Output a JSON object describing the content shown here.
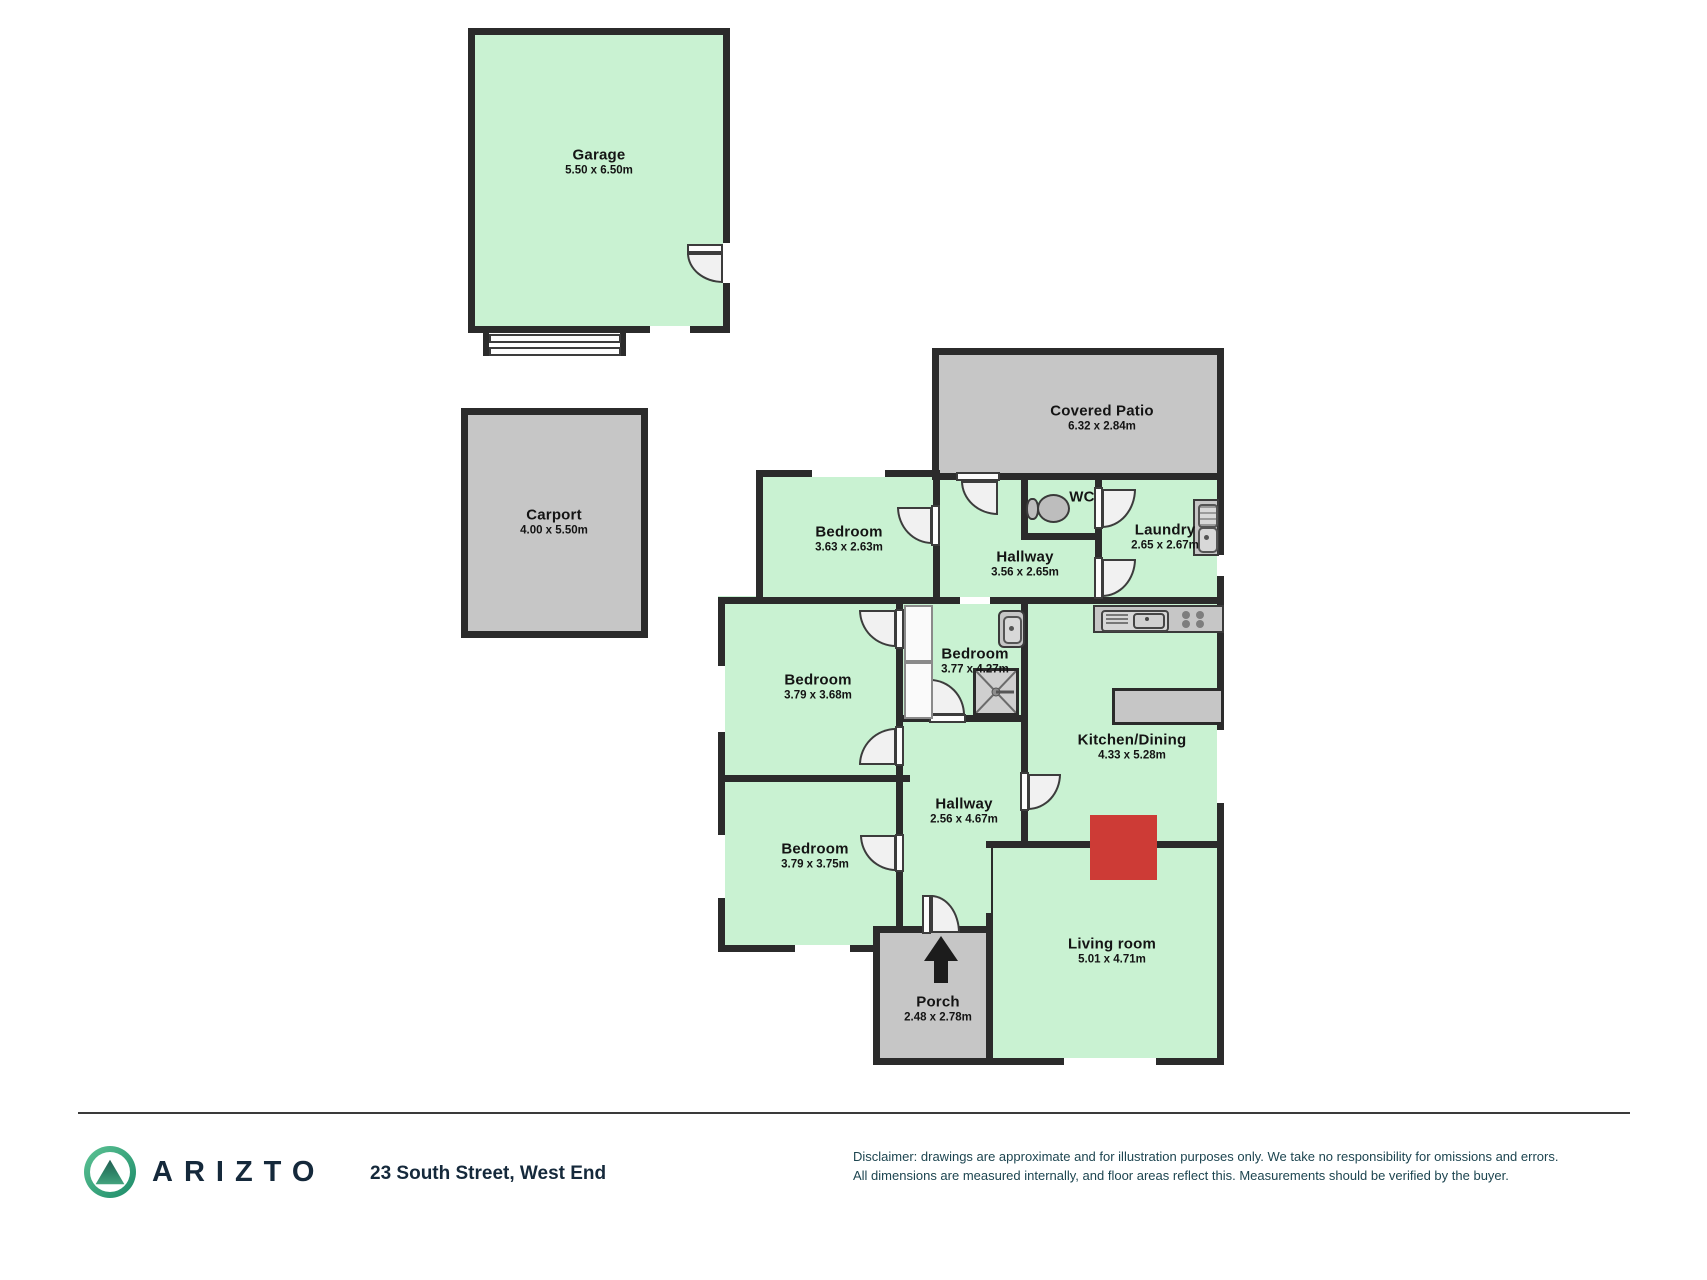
{
  "title": "Floor plan",
  "rooms": [
    {
      "id": "garage",
      "name": "Garage",
      "dims": "5.50 x 6.50m"
    },
    {
      "id": "carport",
      "name": "Carport",
      "dims": "4.00 x 5.50m"
    },
    {
      "id": "covered-patio",
      "name": "Covered Patio",
      "dims": "6.32 x 2.84m"
    },
    {
      "id": "bedroom-1",
      "name": "Bedroom",
      "dims": "3.63 x 2.63m"
    },
    {
      "id": "hallway-top",
      "name": "Hallway",
      "dims": "3.56 x 2.65m"
    },
    {
      "id": "wc",
      "name": "WC",
      "dims": ""
    },
    {
      "id": "laundry",
      "name": "Laundry",
      "dims": "2.65 x 2.67m"
    },
    {
      "id": "bedroom-2",
      "name": "Bedroom",
      "dims": "3.79 x 3.68m"
    },
    {
      "id": "bedroom-middle",
      "name": "Bedroom",
      "dims": "3.77 x 4.27m"
    },
    {
      "id": "kitchen-dining",
      "name": "Kitchen/Dining",
      "dims": "4.33 x 5.28m"
    },
    {
      "id": "hallway-main",
      "name": "Hallway",
      "dims": "2.56 x 4.67m"
    },
    {
      "id": "bedroom-3",
      "name": "Bedroom",
      "dims": "3.79 x 3.75m"
    },
    {
      "id": "living-room",
      "name": "Living room",
      "dims": "5.01 x 4.71m"
    },
    {
      "id": "porch",
      "name": "Porch",
      "dims": "2.48 x 2.78m"
    }
  ],
  "footer": {
    "brand": "ARIZTO",
    "address": "23 South Street, West End",
    "disclaimer_line1": "Disclaimer: drawings are approximate and for illustration purposes only. We take no responsibility for omissions and errors.",
    "disclaimer_line2": "All dimensions are measured internally, and floor areas reflect this. Measurements should be verified by the buyer."
  },
  "colors": {
    "wall": "#2b2b2b",
    "room_green": "#c9f2d2",
    "area_gray": "#c6c6c6",
    "fireplace_red": "#cd3b36",
    "door_fill": "#f1f1f1",
    "brand_navy": "#15293b",
    "footer_text": "#1d4550",
    "logo_green_1": "#5ec495",
    "logo_green_2": "#1b8a68"
  }
}
